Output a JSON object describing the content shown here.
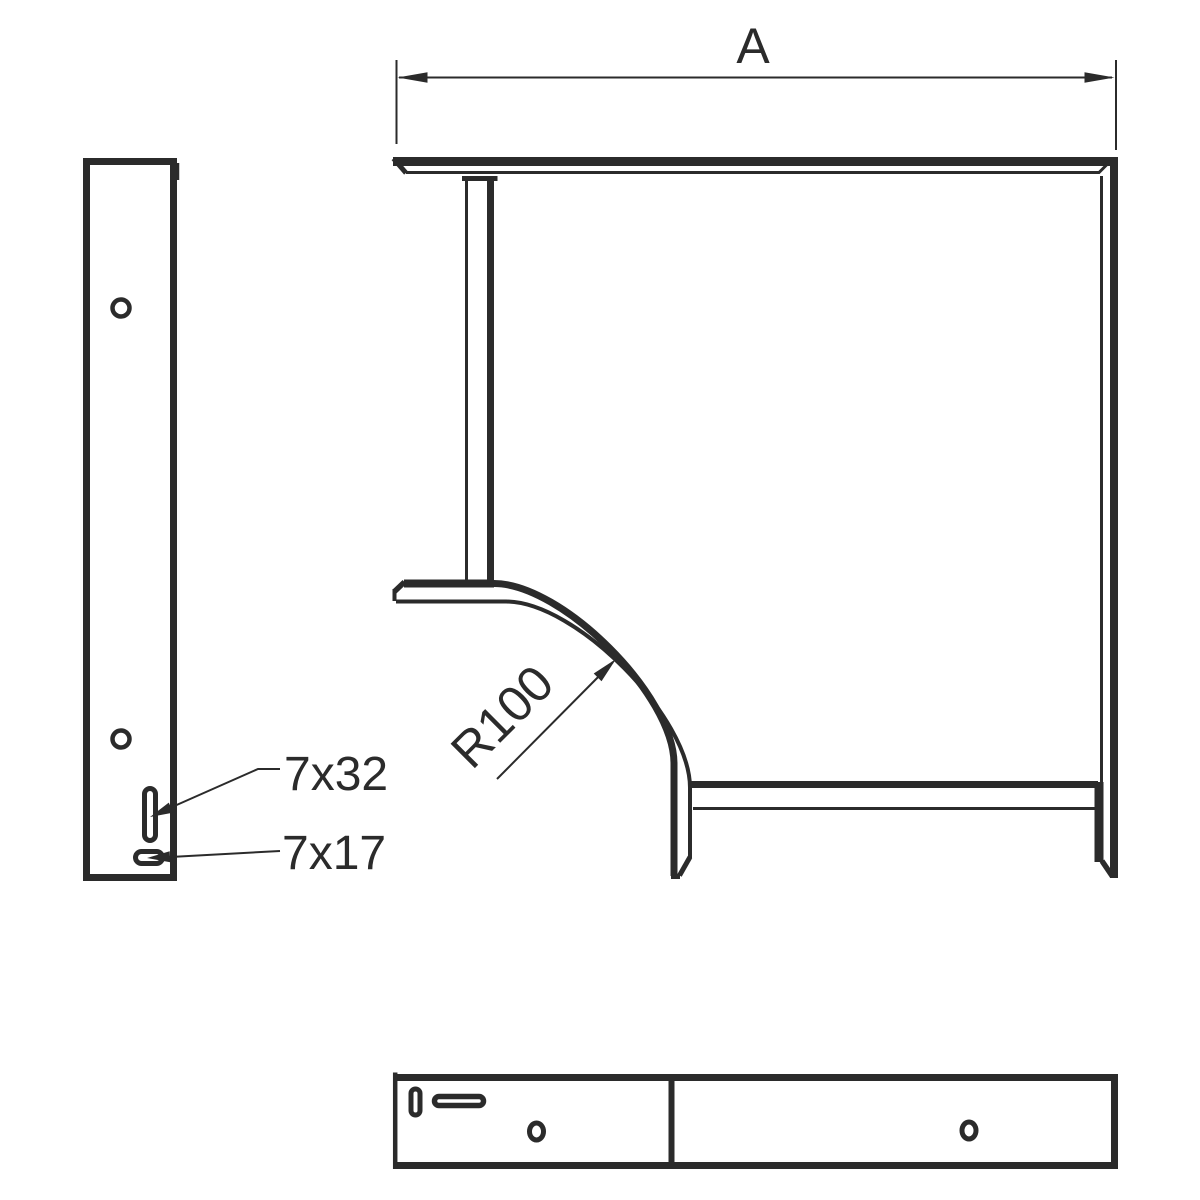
{
  "drawing": {
    "type": "technical-drawing",
    "subject": "90-degree-bend-three-view",
    "colors": {
      "line": "#2b2b2b",
      "background": "#ffffff"
    },
    "dimension": {
      "width_label": "A"
    },
    "radius": {
      "label": "R100"
    },
    "slots": {
      "vertical_slot_label": "7x32",
      "horizontal_slot_label": "7x17"
    }
  }
}
